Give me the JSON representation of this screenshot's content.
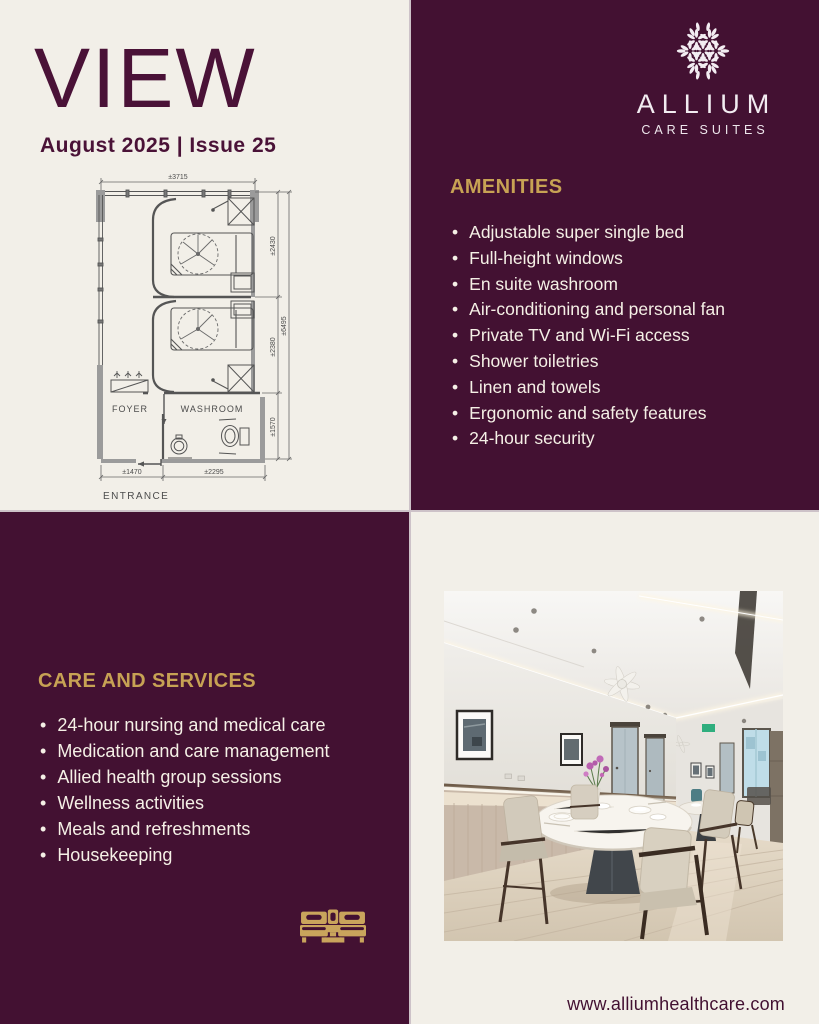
{
  "masthead": {
    "title": "VIEW",
    "issue": "August 2025 | Issue 25"
  },
  "brand": {
    "name": "ALLIUM",
    "tagline": "CARE SUITES"
  },
  "amenities": {
    "heading": "AMENITIES",
    "items": [
      "Adjustable super single bed",
      "Full-height windows",
      "En suite washroom",
      "Air-conditioning and personal fan",
      "Private TV and Wi-Fi access",
      "Shower toiletries",
      "Linen and towels",
      "Ergonomic and safety features",
      "24-hour security"
    ]
  },
  "care_services": {
    "heading": "CARE AND SERVICES",
    "items": [
      "24-hour nursing and medical care",
      "Medication and care management",
      "Allied health group sessions",
      "Wellness activities",
      "Meals and refreshments",
      "Housekeeping"
    ]
  },
  "floor_plan": {
    "labels": {
      "foyer": "FOYER",
      "washroom": "WASHROOM",
      "entrance": "ENTRANCE"
    },
    "dimensions": {
      "width_top": "±3715",
      "right_room1": "±2430",
      "right_room2": "±2380",
      "right_washroom": "±1570",
      "right_total": "±6495",
      "bottom_left": "±1470",
      "bottom_right": "±2295"
    }
  },
  "footer": {
    "website": "www.alliumhealthcare.com"
  },
  "icons": {
    "logo": "allium-flower-icon",
    "services": "twin-beds-icon"
  },
  "colors": {
    "purple": "#431132",
    "cream": "#f2efe8",
    "gold": "#c7a254",
    "ink_purple": "#4a1237",
    "list_text": "#f5f0e6"
  }
}
